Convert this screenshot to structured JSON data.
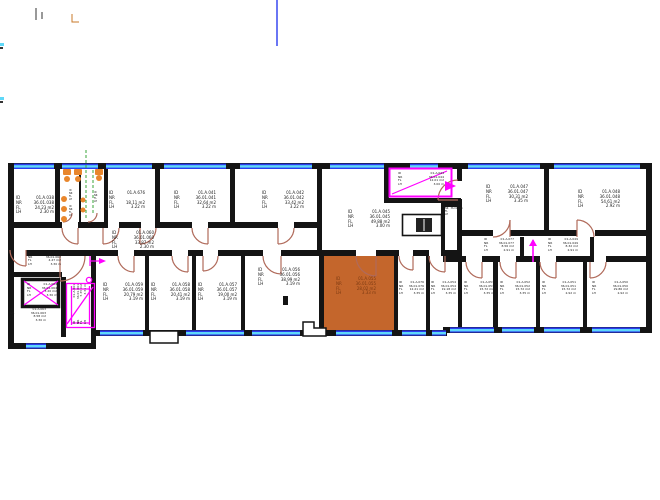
{
  "drawing": {
    "type": "floor-plan",
    "background": "#ffffff"
  },
  "colors": {
    "wall": "#141414",
    "window_blue": "#2b3cf0",
    "window_cyan": "#5fd8f8",
    "door_arc": "#b06a5a",
    "revision_magenta": "#ff00ff",
    "highlight_room_fill": "#c4662c",
    "fixture_orange": "#e8862c",
    "installation_green": "#3aa53a",
    "text": "#1a1a1a"
  },
  "label_keys": {
    "id": "ID",
    "nr": "NR",
    "fl": "FL",
    "lh": "LH"
  },
  "rooms": [
    {
      "id": "01.A.038",
      "nr": "36.01.038",
      "fl": "24.23 m2",
      "lh": "2.30 m"
    },
    {
      "id": "01.A.676",
      "nr": "",
      "fl": "18.11 m2",
      "lh": "3.22 m"
    },
    {
      "id": "01.A.041",
      "nr": "36.01.041",
      "fl": "32.64 m2",
      "lh": "3.22 m"
    },
    {
      "id": "01.A.042",
      "nr": "36.01.042",
      "fl": "33.42 m2",
      "lh": "3.22 m"
    },
    {
      "id": "01.A.044",
      "nr": "36.01.044",
      "fl": "12.01 m2",
      "lh": "3.00 m"
    },
    {
      "id": "01.A.045",
      "nr": "36.01.045",
      "fl": "49.88 m2",
      "lh": "3.00 m"
    },
    {
      "id": "01.A.047",
      "nr": "36.01.047",
      "fl": "30.31 m2",
      "lh": "3.35 m"
    },
    {
      "id": "01.A.048",
      "nr": "36.01.048",
      "fl": "54.61 m2",
      "lh": "2.92 m"
    },
    {
      "id": "01.A.060",
      "nr": "36.01.060",
      "fl": "33.87 m2",
      "lh": "2.30 m"
    },
    {
      "id": "01.A.077",
      "nr": "36.01.077",
      "fl": "8.56 m2",
      "lh": "2.91 m"
    },
    {
      "id": "01.A.049",
      "nr": "36.01.049",
      "fl": "8.32 m2",
      "lh": "2.91 m"
    },
    {
      "id": "01.A.046",
      "nr": "36.01.046",
      "fl": "",
      "lh": ""
    },
    {
      "id": "01.A.062",
      "nr": "36.01.062",
      "fl": "4.47 m2",
      "lh": "3.30 m"
    },
    {
      "id": "01.A.064",
      "nr": "36.01.064",
      "fl": "3.20 m2",
      "lh": "3.30 m"
    },
    {
      "id": "01.A.063",
      "nr": "36.01.063",
      "fl": "8.58 m2",
      "lh": "3.30 m"
    },
    {
      "id": "01.A.061",
      "nr": "36.01.061",
      "fl": "5.35 m2",
      "lh": "3.31 m"
    },
    {
      "id": "01.A.059",
      "nr": "36.01.059",
      "fl": "20.79 m2",
      "lh": "3.19 m"
    },
    {
      "id": "01.A.058",
      "nr": "36.01.058",
      "fl": "20.41 m2",
      "lh": "3.19 m"
    },
    {
      "id": "01.A.057",
      "nr": "36.01.057",
      "fl": "19.00 m2",
      "lh": "3.19 m"
    },
    {
      "id": "01.A.056",
      "nr": "36.01.056",
      "fl": "38.99 m2",
      "lh": "3.19 m"
    },
    {
      "id": "01.A.055",
      "nr": "36.01.055",
      "fl": "28.02 m2",
      "lh": "3.33 m"
    },
    {
      "id": "01.A.076",
      "nr": "36.01.076",
      "fl": "12.21 m2",
      "lh": "3.35 m"
    },
    {
      "id": "01.A.054",
      "nr": "36.01.054",
      "fl": "19.18 m2",
      "lh": "3.35 m"
    },
    {
      "id": "01.A.053",
      "nr": "36.01.053",
      "fl": "15.72 m2",
      "lh": "3.35 m"
    },
    {
      "id": "01.A.052",
      "nr": "36.01.052",
      "fl": "15.72 m2",
      "lh": "3.35 m"
    },
    {
      "id": "01.A.051",
      "nr": "36.01.051",
      "fl": "15.72 m2",
      "lh": "2.92 m"
    },
    {
      "id": "01.A.050",
      "nr": "36.01.050",
      "fl": "29.86 m2",
      "lh": "2.92 m"
    },
    {
      "id": "",
      "nr": "",
      "fl": "",
      "lh": ""
    },
    {
      "id": "",
      "nr": "",
      "fl": "",
      "lh": ""
    },
    {
      "id": "",
      "nr": "",
      "fl": "",
      "lh": ""
    }
  ]
}
